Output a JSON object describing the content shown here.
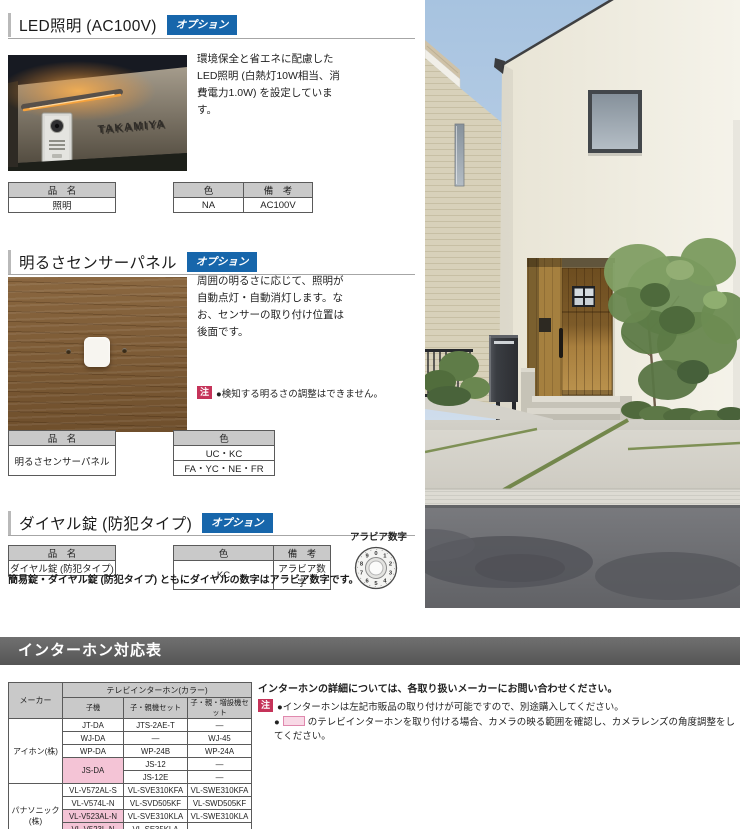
{
  "colors": {
    "accent_blue": "#1766ab",
    "note_red": "#c53359",
    "highlight_pink": "#f4c4d6",
    "table_header_gray": "#c9c9c9",
    "section_bar_gray": "#5e5e5e"
  },
  "sections": {
    "led": {
      "title": "LED照明 (AC100V)",
      "badge": "オプション",
      "description": "環境保全と省エネに配慮したLED照明 (白熱灯10W相当、消費電力1.0W) を設定しています。",
      "photo_nameplate": "TAKAMIYA",
      "name_table": {
        "header": "品　名",
        "value": "照明"
      },
      "spec_table": {
        "color_header": "色",
        "note_header": "備　考",
        "color_value": "NA",
        "note_value": "AC100V"
      }
    },
    "sensor": {
      "title": "明るさセンサーパネル",
      "badge": "オプション",
      "description": "周囲の明るさに応じて、照明が自動点灯・自動消灯します。なお、センサーの取り付け位置は後面です。",
      "note_badge": "注",
      "note": "●検知する明るさの調整はできません。",
      "name_table": {
        "header": "品　名",
        "value": "明るさセンサーパネル"
      },
      "color_table": {
        "header": "色",
        "rows": [
          "UC・KC",
          "FA・YC・NE・FR"
        ]
      }
    },
    "dial": {
      "title": "ダイヤル錠 (防犯タイプ)",
      "badge": "オプション",
      "name_table": {
        "header": "品　名",
        "value": "ダイヤル錠 (防犯タイプ)"
      },
      "spec_table": {
        "color_header": "色",
        "note_header": "備　考",
        "color_value": "KC",
        "note_value": "アラビア数字"
      },
      "note": "簡易錠・ダイヤル錠 (防犯タイプ) ともにダイヤルの数字はアラビア数字です。",
      "dial_label": "アラビア数字",
      "dial_digits": "0123456789"
    }
  },
  "intercom": {
    "bar_title": "インターホン対応表",
    "table": {
      "maker_header": "メーカー",
      "group_header": "テレビインターホン(カラー)",
      "sub_headers": [
        "子機",
        "子・親機セット",
        "子・親・増設機セット"
      ],
      "maker_aiphone": "アイホン(株)",
      "maker_panasonic": "パナソニック(株)",
      "rows": [
        {
          "c0": "JT-DA",
          "c1": "JTS-2AE-T",
          "c2": "―"
        },
        {
          "c0": "WJ-DA",
          "c1": "―",
          "c2": "WJ-45"
        },
        {
          "c0": "WP-DA",
          "c1": "WP-24B",
          "c2": "WP-24A"
        },
        {
          "c0": "JS-DA",
          "c1": "JS-12",
          "c2": "―"
        },
        {
          "c1": "JS-12E",
          "c2": "―"
        },
        {
          "c0": "VL-V572AL-S",
          "c1": "VL-SVE310KFA",
          "c2": "VL-SWE310KFA"
        },
        {
          "c0": "VL-V574L-N",
          "c1": "VL-SVD505KF",
          "c2": "VL-SWD505KF"
        },
        {
          "c0": "VL-V523AL-N",
          "c1": "VL-SVE310KLA",
          "c2": "VL-SWE310KLA"
        },
        {
          "c0": "VL-V523L-N",
          "c1": "VL-SE35KLA",
          "c2": "―"
        },
        {
          "c0": "VL-VH575AL-H",
          "c1": "VL-SVE710KF",
          "c2": "VL-SWE710KF"
        }
      ]
    },
    "notes": {
      "contact": "インターホンの詳細については、各取り扱いメーカーにお問い合わせください。",
      "badge": "注",
      "note1": "●インターホンは左記市販品の取り付けが可能ですので、別途購入してください。",
      "note2_prefix": "●",
      "note2_suffix": "のテレビインターホンを取り付ける場合、カメラの映る範囲を確認し、カメラレンズの角度調整をしてください。"
    }
  }
}
